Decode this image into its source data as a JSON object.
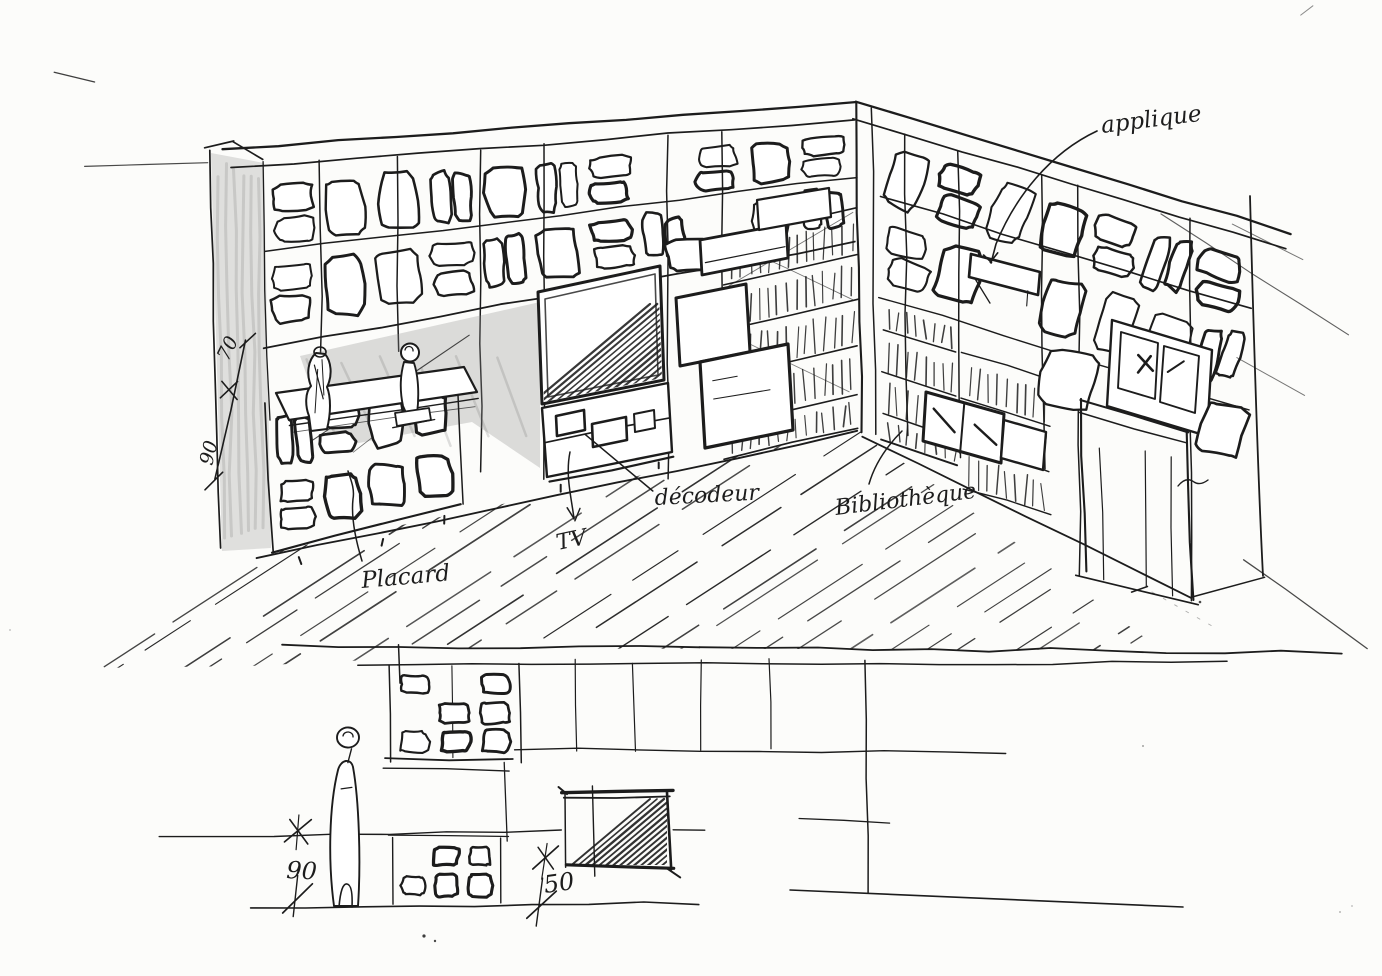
{
  "document": {
    "paper_color": "#fcfcfa",
    "ink_color": "#1c1c1c",
    "pencil_color": "#8f8f8f"
  },
  "perspective_view": {
    "annotations": {
      "applique": "applique",
      "decodeur": "décodeur",
      "tv": "TV",
      "placard": "Placard",
      "bibliotheque": "Bibliothèque"
    },
    "dimensions": {
      "upper_segment": "70",
      "lower_segment": "90"
    }
  },
  "elevation_view": {
    "dimensions": {
      "left_height": "90",
      "center_depth": "50"
    }
  }
}
